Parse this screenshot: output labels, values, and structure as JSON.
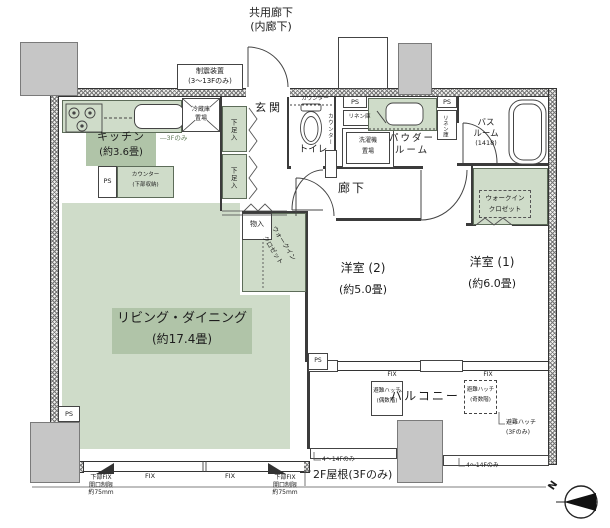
{
  "colors": {
    "room_green": "#cfdcc9",
    "label_green": "#b0c4a8",
    "column_gray": "#c6c6c6",
    "line": "#3b3b3b"
  },
  "plan": {
    "common_corridor_l1": "共用廊下",
    "common_corridor_l2": "(内廊下)",
    "seismic_l1": "制震装置",
    "seismic_l2": "(3〜13Fのみ)",
    "kitchen_name": "キッチン",
    "kitchen_size": "(約3.6畳)",
    "kitchen_note": "―3Fのみ",
    "counter_l1": "カウンター",
    "counter_l2": "(下部収納)",
    "fridge_l1": "冷蔵庫",
    "fridge_l2": "置場",
    "shoe": "下足入",
    "entrance": "玄関",
    "toilet": "トイレ",
    "toilet_counter": "カウンター",
    "ps": "PS",
    "linen": "リネン庫",
    "washer_l1": "洗濯機",
    "washer_l2": "置場",
    "powder_l1": "パウダー",
    "powder_l2": "ルーム",
    "bath_l1": "バス",
    "bath_l2": "ルーム",
    "bath_size": "(1418)",
    "corridor": "廊下",
    "storage": "物入",
    "wic_l1": "ウォークイン",
    "wic_l2": "クロゼット",
    "room2_name": "洋室 (2)",
    "room2_size": "(約5.0畳)",
    "room1_name": "洋室 (1)",
    "room1_size": "(約6.0畳)",
    "living_name": "リビング・ダイニング",
    "living_size": "(約17.4畳)",
    "balcony": "バルコニー",
    "hatch_even_l1": "避難ハッチ",
    "hatch_even_l2": "(偶数階)",
    "hatch_odd_l1": "避難ハッチ",
    "hatch_odd_l2": "(奇数階)",
    "hatch_3f_l1": "避難ハッチ",
    "hatch_3f_l2": "(3Fのみ)",
    "fix": "FIX",
    "lower_fix_l1": "下部FIX",
    "lower_fix_l2": "開口制限",
    "lower_fix_l3": "約75mm",
    "floors_4_14": "4〜14Fのみ",
    "roof_2f": "2F屋根(3Fのみ)",
    "compass_n": "N"
  }
}
